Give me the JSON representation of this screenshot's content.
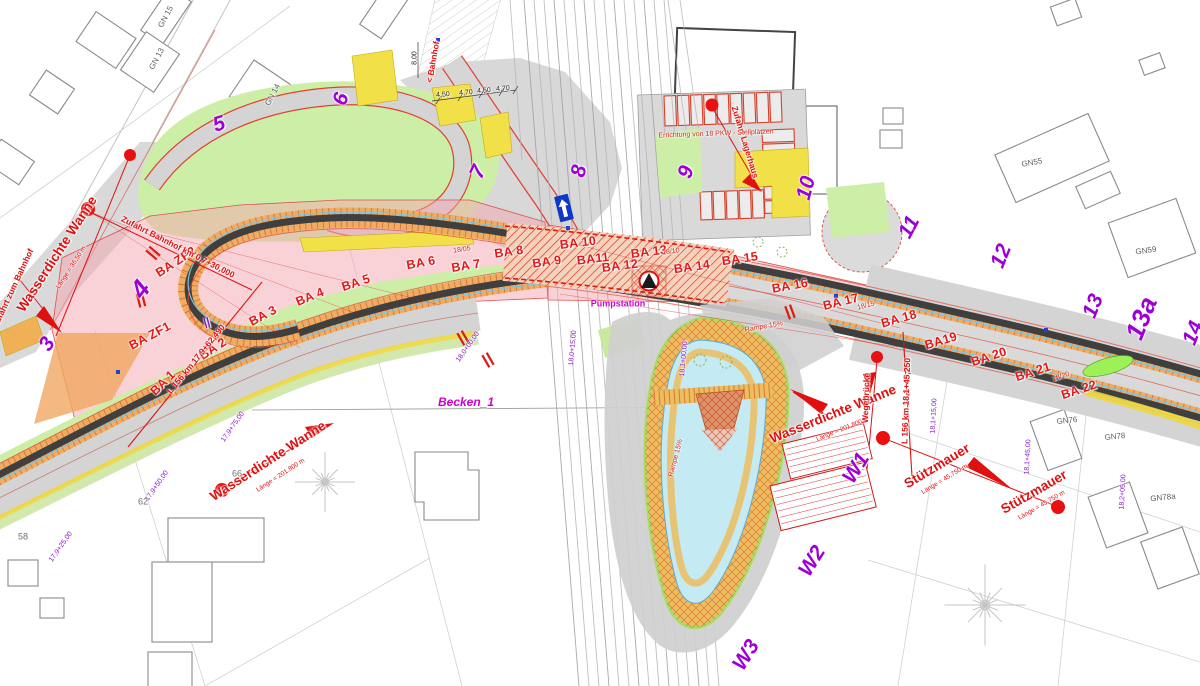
{
  "plan": {
    "type": "construction-site-plan",
    "colors": {
      "phase_number": "#9d00d6",
      "annotation_red": "#e01010",
      "magenta": "#cf00cf",
      "chainage_purple": "#8b17cc",
      "pink_zone": "#f3a6af",
      "corridor_orange": "#f0ad62",
      "trough_dark": "#3f3f3f",
      "water_blue": "#c4ebf4",
      "green_area": "#cdeea6",
      "yellow_island": "#f2e049"
    },
    "labels": [
      {
        "n": "ba-zf2",
        "t": "BA ZF2",
        "x": 176,
        "y": 262,
        "r": -33,
        "c": "ba"
      },
      {
        "n": "ba-zf1",
        "t": "BA ZF1",
        "x": 150,
        "y": 336,
        "r": -28,
        "c": "ba"
      },
      {
        "n": "ba-1",
        "t": "BA 1",
        "x": 163,
        "y": 383,
        "r": -45,
        "c": "ba"
      },
      {
        "n": "ba-2",
        "t": "BA 2",
        "x": 213,
        "y": 349,
        "r": -33,
        "c": "ba"
      },
      {
        "n": "ba-3",
        "t": "BA 3",
        "x": 263,
        "y": 316,
        "r": -28,
        "c": "ba"
      },
      {
        "n": "ba-4",
        "t": "BA 4",
        "x": 310,
        "y": 297,
        "r": -22,
        "c": "ba"
      },
      {
        "n": "ba-5",
        "t": "BA 5",
        "x": 356,
        "y": 283,
        "r": -18,
        "c": "ba"
      },
      {
        "n": "ba-6",
        "t": "BA 6",
        "x": 421,
        "y": 263,
        "r": -10,
        "c": "ba"
      },
      {
        "n": "ba-7",
        "t": "BA 7",
        "x": 466,
        "y": 266,
        "r": -9,
        "c": "ba"
      },
      {
        "n": "ba-8",
        "t": "BA 8",
        "x": 509,
        "y": 252,
        "r": -8,
        "c": "ba"
      },
      {
        "n": "ba-9",
        "t": "BA 9",
        "x": 547,
        "y": 262,
        "r": -8,
        "c": "ba"
      },
      {
        "n": "ba-10",
        "t": "BA 10",
        "x": 578,
        "y": 243,
        "r": -7,
        "c": "ba"
      },
      {
        "n": "ba-11",
        "t": "BA11",
        "x": 593,
        "y": 259,
        "r": -7,
        "c": "ba"
      },
      {
        "n": "ba-12",
        "t": "BA 12",
        "x": 620,
        "y": 266,
        "r": -7,
        "c": "ba"
      },
      {
        "n": "ba-13",
        "t": "BA 13",
        "x": 649,
        "y": 252,
        "r": -7,
        "c": "ba"
      },
      {
        "n": "ba-14",
        "t": "BA 14",
        "x": 692,
        "y": 267,
        "r": -8,
        "c": "ba"
      },
      {
        "n": "ba-15",
        "t": "BA 15",
        "x": 740,
        "y": 259,
        "r": -8,
        "c": "ba"
      },
      {
        "n": "ba-16",
        "t": "BA 16",
        "x": 790,
        "y": 286,
        "r": -10,
        "c": "ba"
      },
      {
        "n": "ba-17",
        "t": "BA 17",
        "x": 841,
        "y": 302,
        "r": -14,
        "c": "ba"
      },
      {
        "n": "ba-18",
        "t": "BA 18",
        "x": 899,
        "y": 319,
        "r": -16,
        "c": "ba"
      },
      {
        "n": "ba-19",
        "t": "BA19",
        "x": 941,
        "y": 341,
        "r": -17,
        "c": "ba"
      },
      {
        "n": "ba-20",
        "t": "BA 20",
        "x": 989,
        "y": 357,
        "r": -18,
        "c": "ba"
      },
      {
        "n": "ba-21",
        "t": "BA 21",
        "x": 1033,
        "y": 372,
        "r": -18,
        "c": "ba"
      },
      {
        "n": "ba-22",
        "t": "BA 22",
        "x": 1079,
        "y": 390,
        "r": -18,
        "c": "ba"
      },
      {
        "n": "phase-3",
        "t": "3",
        "x": 47,
        "y": 344,
        "r": -58,
        "c": "phase"
      },
      {
        "n": "phase-4",
        "t": "4",
        "x": 140,
        "y": 289,
        "r": -52,
        "c": "phase-lg"
      },
      {
        "n": "phase-5",
        "t": "5",
        "x": 219,
        "y": 124,
        "r": -18,
        "c": "phase"
      },
      {
        "n": "phase-6",
        "t": "6",
        "x": 341,
        "y": 99,
        "r": -72,
        "c": "phase"
      },
      {
        "n": "phase-7",
        "t": "7",
        "x": 478,
        "y": 172,
        "r": -65,
        "c": "phase"
      },
      {
        "n": "phase-8",
        "t": "8",
        "x": 579,
        "y": 171,
        "r": -78,
        "c": "phase"
      },
      {
        "n": "phase-9",
        "t": "9",
        "x": 686,
        "y": 172,
        "r": -72,
        "c": "phase"
      },
      {
        "n": "phase-10",
        "t": "10",
        "x": 806,
        "y": 188,
        "r": -75,
        "c": "phase"
      },
      {
        "n": "phase-11",
        "t": "11",
        "x": 909,
        "y": 227,
        "r": -62,
        "c": "phase"
      },
      {
        "n": "phase-12",
        "t": "12",
        "x": 1001,
        "y": 256,
        "r": -68,
        "c": "phase"
      },
      {
        "n": "phase-13",
        "t": "13",
        "x": 1093,
        "y": 306,
        "r": -68,
        "c": "phase"
      },
      {
        "n": "phase-13a",
        "t": "13a",
        "x": 1141,
        "y": 318,
        "r": -68,
        "c": "phase-lg"
      },
      {
        "n": "phase-14",
        "t": "14",
        "x": 1193,
        "y": 333,
        "r": -68,
        "c": "phase"
      },
      {
        "n": "wall-w1",
        "t": "W1",
        "x": 856,
        "y": 468,
        "r": -58,
        "c": "phase"
      },
      {
        "n": "wall-w2",
        "t": "W2",
        "x": 812,
        "y": 561,
        "r": -58,
        "c": "phase"
      },
      {
        "n": "wall-w3",
        "t": "W3",
        "x": 746,
        "y": 655,
        "r": -58,
        "c": "phase"
      },
      {
        "n": "wanne-left",
        "t": "Wasserdichte Wanne",
        "x": 57,
        "y": 254,
        "r": -57,
        "c": "red-lg"
      },
      {
        "n": "wanne-left-len",
        "t": "Länge = 36,50 m",
        "x": 72,
        "y": 268,
        "r": -57,
        "c": "red-sub"
      },
      {
        "n": "zufahrt-zum-bahnhof",
        "t": "Zufahrt zum Bahnhof",
        "x": 13,
        "y": 288,
        "r": -65,
        "c": "red-sm"
      },
      {
        "n": "zufahrt-bahnhof",
        "t": "Zufahrt Bahnhof km 0,7+30,000",
        "x": 178,
        "y": 247,
        "r": 27,
        "c": "red-sm"
      },
      {
        "n": "zufahrt-lagerhaus",
        "t": "Zufahrt Lagerhaus",
        "x": 745,
        "y": 142,
        "r": 73,
        "c": "red-sm"
      },
      {
        "n": "wanne-sw",
        "t": "Wasserdichte Wanne",
        "x": 268,
        "y": 461,
        "r": -33,
        "c": "red-lg"
      },
      {
        "n": "wanne-sw-len",
        "t": "Länge = 201,800 m",
        "x": 281,
        "y": 476,
        "r": -33,
        "c": "red-sub"
      },
      {
        "n": "wanne-mid",
        "t": "Wasserdichte Wanne",
        "x": 833,
        "y": 414,
        "r": -22,
        "c": "red-lg"
      },
      {
        "n": "wanne-mid-len",
        "t": "Länge = 201,800 m",
        "x": 843,
        "y": 430,
        "r": -22,
        "c": "red-sub"
      },
      {
        "n": "stuetzmauer-1",
        "t": "Stützmauer",
        "x": 937,
        "y": 466,
        "r": -31,
        "c": "red-lg"
      },
      {
        "n": "stuetzmauer-1-len",
        "t": "Länge = 45,750 m",
        "x": 945,
        "y": 480,
        "r": -31,
        "c": "red-sub"
      },
      {
        "n": "stuetzmauer-2",
        "t": "Stützmauer",
        "x": 1034,
        "y": 492,
        "r": -30,
        "c": "red-lg"
      },
      {
        "n": "stuetzmauer-2-len",
        "t": "Länge = 45,750 m",
        "x": 1042,
        "y": 506,
        "r": -30,
        "c": "red-sub"
      },
      {
        "n": "wegebruecke",
        "t": "Wegebrücke",
        "x": 866,
        "y": 398,
        "r": -88,
        "c": "red-sm"
      },
      {
        "n": "l156-west",
        "t": "L 156 km 17,9+62,490",
        "x": 196,
        "y": 359,
        "r": -51,
        "c": "red-sm"
      },
      {
        "n": "l156-east",
        "t": "L 156 km 18,1+45,250",
        "x": 906,
        "y": 401,
        "r": -88,
        "c": "red-sm"
      },
      {
        "n": "stellplaetze",
        "t": "Errichtung von 18 PKW - Stellplätzen",
        "x": 716,
        "y": 134,
        "r": -2,
        "c": "red-tiny"
      },
      {
        "n": "bahnhof-arrow-label",
        "t": "< Bahnhof",
        "x": 433,
        "y": 62,
        "r": -80,
        "c": "red-sm"
      },
      {
        "n": "becken-1",
        "t": "Becken_1",
        "x": 466,
        "y": 402,
        "r": 0,
        "c": "mag"
      },
      {
        "n": "pumpstation",
        "t": "Pumpstation",
        "x": 618,
        "y": 304,
        "r": 0,
        "c": "mag-sm"
      },
      {
        "n": "rampe-1",
        "t": "Rampe 15%",
        "x": 764,
        "y": 327,
        "r": -10,
        "c": "red-tiny"
      },
      {
        "n": "rampe-2",
        "t": "Rampe 15%",
        "x": 676,
        "y": 458,
        "r": -75,
        "c": "red-tiny"
      },
      {
        "n": "km-18-05",
        "t": "18/05",
        "x": 462,
        "y": 250,
        "r": -8,
        "c": "red-tiny"
      },
      {
        "n": "km-18-10",
        "t": "18/10",
        "x": 671,
        "y": 252,
        "r": -8,
        "c": "red-tiny"
      },
      {
        "n": "km-18-15",
        "t": "18/15",
        "x": 866,
        "y": 306,
        "r": -15,
        "c": "red-tiny"
      },
      {
        "n": "km-18-20",
        "t": "18/20",
        "x": 1061,
        "y": 377,
        "r": -18,
        "c": "red-tiny"
      },
      {
        "n": "ch-17-9-25",
        "t": "17,9+25,00",
        "x": 61,
        "y": 547,
        "r": -55,
        "c": "chain"
      },
      {
        "n": "ch-17-9-50",
        "t": "17,9+50,00",
        "x": 157,
        "y": 486,
        "r": -55,
        "c": "chain"
      },
      {
        "n": "ch-17-9-75",
        "t": "17,9+75,00",
        "x": 233,
        "y": 427,
        "r": -55,
        "c": "chain"
      },
      {
        "n": "ch-18-0-00",
        "t": "18,0+00,00",
        "x": 468,
        "y": 347,
        "r": -55,
        "c": "chain"
      },
      {
        "n": "ch-18-0-15",
        "t": "18,0+15,00",
        "x": 573,
        "y": 348,
        "r": -85,
        "c": "chain"
      },
      {
        "n": "ch-18-1-00",
        "t": "18,1+00,00",
        "x": 684,
        "y": 359,
        "r": -85,
        "c": "chain"
      },
      {
        "n": "ch-18-1-15",
        "t": "18,1+15,00",
        "x": 934,
        "y": 416,
        "r": -87,
        "c": "chain"
      },
      {
        "n": "ch-18-1-45",
        "t": "18,1+45,00",
        "x": 1028,
        "y": 457,
        "r": -87,
        "c": "chain"
      },
      {
        "n": "ch-18-2-05",
        "t": "18,2+05,00",
        "x": 1123,
        "y": 492,
        "r": -87,
        "c": "chain"
      },
      {
        "n": "joint-mark",
        "t": "||",
        "x": 207,
        "y": 323,
        "r": -15,
        "c": "chain-md"
      },
      {
        "n": "bld-gn15",
        "t": "GN 15",
        "x": 166,
        "y": 17,
        "r": -62,
        "c": "bld"
      },
      {
        "n": "bld-gn13",
        "t": "GN 13",
        "x": 157,
        "y": 59,
        "r": -62,
        "c": "bld"
      },
      {
        "n": "bld-gn14",
        "t": "GN 14",
        "x": 273,
        "y": 95,
        "r": -62,
        "c": "bld"
      },
      {
        "n": "bld-gn55",
        "t": "GN55",
        "x": 1032,
        "y": 163,
        "r": -10,
        "c": "bld"
      },
      {
        "n": "bld-gn59",
        "t": "GN59",
        "x": 1146,
        "y": 251,
        "r": -8,
        "c": "bld"
      },
      {
        "n": "bld-gn76",
        "t": "GN76",
        "x": 1067,
        "y": 421,
        "r": -6,
        "c": "bld"
      },
      {
        "n": "bld-gn78",
        "t": "GN78",
        "x": 1115,
        "y": 437,
        "r": -6,
        "c": "bld"
      },
      {
        "n": "bld-gn78a",
        "t": "GN78a",
        "x": 1163,
        "y": 498,
        "r": -6,
        "c": "bld"
      },
      {
        "n": "parcel-58",
        "t": "58",
        "x": 23,
        "y": 537,
        "r": 0,
        "c": "parcel"
      },
      {
        "n": "parcel-62",
        "t": "62",
        "x": 143,
        "y": 502,
        "r": 0,
        "c": "parcel"
      },
      {
        "n": "parcel-66",
        "t": "66",
        "x": 237,
        "y": 474,
        "r": 0,
        "c": "parcel"
      },
      {
        "n": "dim-1",
        "t": "4,50",
        "x": 443,
        "y": 95,
        "r": -4,
        "c": "dim"
      },
      {
        "n": "dim-2",
        "t": "4,70",
        "x": 466,
        "y": 93,
        "r": -4,
        "c": "dim"
      },
      {
        "n": "dim-3",
        "t": "4,50",
        "x": 484,
        "y": 91,
        "r": -4,
        "c": "dim"
      },
      {
        "n": "dim-4",
        "t": "4,70",
        "x": 503,
        "y": 89,
        "r": -4,
        "c": "dim"
      },
      {
        "n": "dim-5",
        "t": "8,00",
        "x": 415,
        "y": 58,
        "r": -90,
        "c": "dim"
      }
    ]
  }
}
